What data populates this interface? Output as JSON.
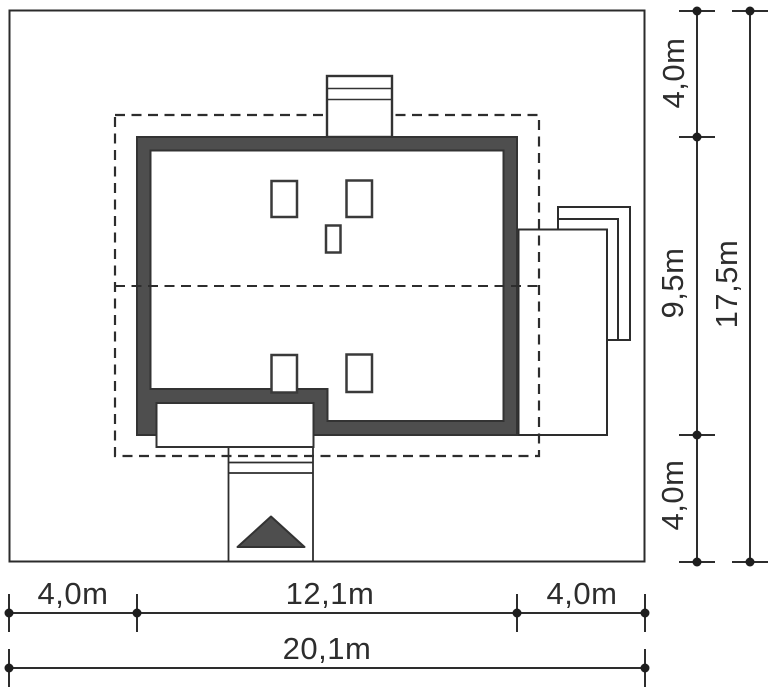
{
  "diagram": {
    "type": "architectural site plan",
    "colors": {
      "background": "#ffffff",
      "line": "#2d2d2d",
      "wall_fill": "#4e4e4e",
      "arrow_fill": "#4e4e4e"
    },
    "dimensions": {
      "right": [
        {
          "id": "right-top",
          "label": "4,0m"
        },
        {
          "id": "right-middle",
          "label": "9,5m"
        },
        {
          "id": "right-bottom",
          "label": "4,0m"
        },
        {
          "id": "right-total",
          "label": "17,5m"
        }
      ],
      "bottom": [
        {
          "id": "bottom-left",
          "label": "4,0m"
        },
        {
          "id": "bottom-middle",
          "label": "12,1m"
        },
        {
          "id": "bottom-right",
          "label": "4,0m"
        },
        {
          "id": "bottom-total",
          "label": "20,1m"
        }
      ]
    }
  }
}
